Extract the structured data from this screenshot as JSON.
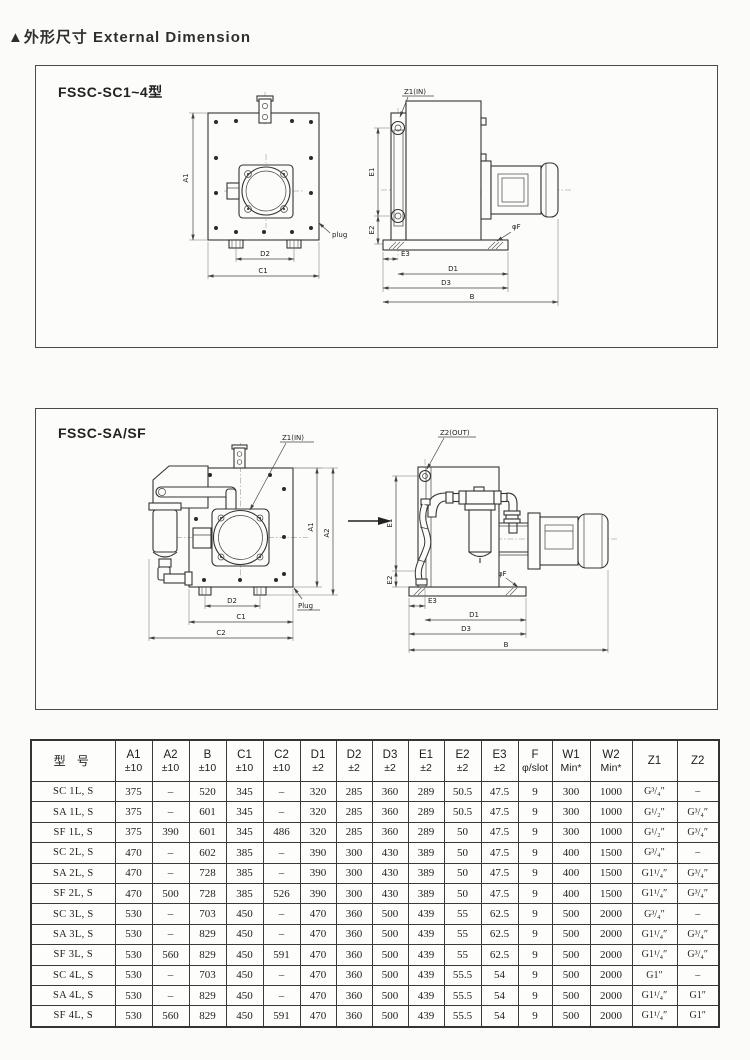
{
  "page": {
    "title": "▲外形尺寸  External Dimension"
  },
  "fig1": {
    "label": "FSSC-SC1~4型",
    "front": {
      "a1": "A1",
      "d2": "D2",
      "c1": "C1",
      "plug": "plug"
    },
    "side": {
      "z1": "Z1(IN)",
      "e1": "E1",
      "e2": "E2",
      "e3": "E3",
      "d1": "D1",
      "d3": "D3",
      "b": "B",
      "phif": "φF"
    }
  },
  "fig2": {
    "label": "FSSC-SA/SF",
    "front": {
      "z1": "Z1(IN)",
      "a1": "A1",
      "a2": "A2",
      "d2": "D2",
      "c1": "C1",
      "c2": "C2",
      "plug": "Plug"
    },
    "side": {
      "z2": "Z2(OUT)",
      "e1": "E1",
      "e2": "E2",
      "e3": "E3",
      "d1": "D1",
      "d3": "D3",
      "b": "B",
      "phif": "φF"
    }
  },
  "table": {
    "headers": [
      {
        "l1": "型  号",
        "l2": ""
      },
      {
        "l1": "A1",
        "l2": "±10"
      },
      {
        "l1": "A2",
        "l2": "±10"
      },
      {
        "l1": "B",
        "l2": "±10"
      },
      {
        "l1": "C1",
        "l2": "±10"
      },
      {
        "l1": "C2",
        "l2": "±10"
      },
      {
        "l1": "D1",
        "l2": "±2"
      },
      {
        "l1": "D2",
        "l2": "±2"
      },
      {
        "l1": "D3",
        "l2": "±2"
      },
      {
        "l1": "E1",
        "l2": "±2"
      },
      {
        "l1": "E2",
        "l2": "±2"
      },
      {
        "l1": "E3",
        "l2": "±2"
      },
      {
        "l1": "F",
        "l2": "φ/slot"
      },
      {
        "l1": "W1",
        "l2": "Min*"
      },
      {
        "l1": "W2",
        "l2": "Min*"
      },
      {
        "l1": "Z1",
        "l2": ""
      },
      {
        "l1": "Z2",
        "l2": ""
      }
    ],
    "rows": [
      [
        "SC 1L, S",
        "375",
        "–",
        "520",
        "345",
        "–",
        "320",
        "285",
        "360",
        "289",
        "50.5",
        "47.5",
        "9",
        "300",
        "1000",
        "G³/₄″",
        "–"
      ],
      [
        "SA 1L, S",
        "375",
        "–",
        "601",
        "345",
        "–",
        "320",
        "285",
        "360",
        "289",
        "50.5",
        "47.5",
        "9",
        "300",
        "1000",
        "G¹/₂″",
        "G³/₄″"
      ],
      [
        "SF 1L, S",
        "375",
        "390",
        "601",
        "345",
        "486",
        "320",
        "285",
        "360",
        "289",
        "50",
        "47.5",
        "9",
        "300",
        "1000",
        "G¹/₂″",
        "G³/₄″"
      ],
      [
        "SC 2L, S",
        "470",
        "–",
        "602",
        "385",
        "–",
        "390",
        "300",
        "430",
        "389",
        "50",
        "47.5",
        "9",
        "400",
        "1500",
        "G³/₄″",
        "–"
      ],
      [
        "SA 2L, S",
        "470",
        "–",
        "728",
        "385",
        "–",
        "390",
        "300",
        "430",
        "389",
        "50",
        "47.5",
        "9",
        "400",
        "1500",
        "G1¹/₄″",
        "G³/₄″"
      ],
      [
        "SF 2L, S",
        "470",
        "500",
        "728",
        "385",
        "526",
        "390",
        "300",
        "430",
        "389",
        "50",
        "47.5",
        "9",
        "400",
        "1500",
        "G1¹/₄″",
        "G³/₄″"
      ],
      [
        "SC 3L, S",
        "530",
        "–",
        "703",
        "450",
        "–",
        "470",
        "360",
        "500",
        "439",
        "55",
        "62.5",
        "9",
        "500",
        "2000",
        "G³/₄″",
        "–"
      ],
      [
        "SA 3L, S",
        "530",
        "–",
        "829",
        "450",
        "–",
        "470",
        "360",
        "500",
        "439",
        "55",
        "62.5",
        "9",
        "500",
        "2000",
        "G1¹/₄″",
        "G³/₄″"
      ],
      [
        "SF 3L, S",
        "530",
        "560",
        "829",
        "450",
        "591",
        "470",
        "360",
        "500",
        "439",
        "55",
        "62.5",
        "9",
        "500",
        "2000",
        "G1¹/₄″",
        "G³/₄″"
      ],
      [
        "SC 4L, S",
        "530",
        "–",
        "703",
        "450",
        "–",
        "470",
        "360",
        "500",
        "439",
        "55.5",
        "54",
        "9",
        "500",
        "2000",
        "G1″",
        "–"
      ],
      [
        "SA 4L, S",
        "530",
        "–",
        "829",
        "450",
        "–",
        "470",
        "360",
        "500",
        "439",
        "55.5",
        "54",
        "9",
        "500",
        "2000",
        "G1¹/₄″",
        "G1″"
      ],
      [
        "SF 4L, S",
        "530",
        "560",
        "829",
        "450",
        "591",
        "470",
        "360",
        "500",
        "439",
        "55.5",
        "54",
        "9",
        "500",
        "2000",
        "G1¹/₄″",
        "G1″"
      ]
    ]
  }
}
